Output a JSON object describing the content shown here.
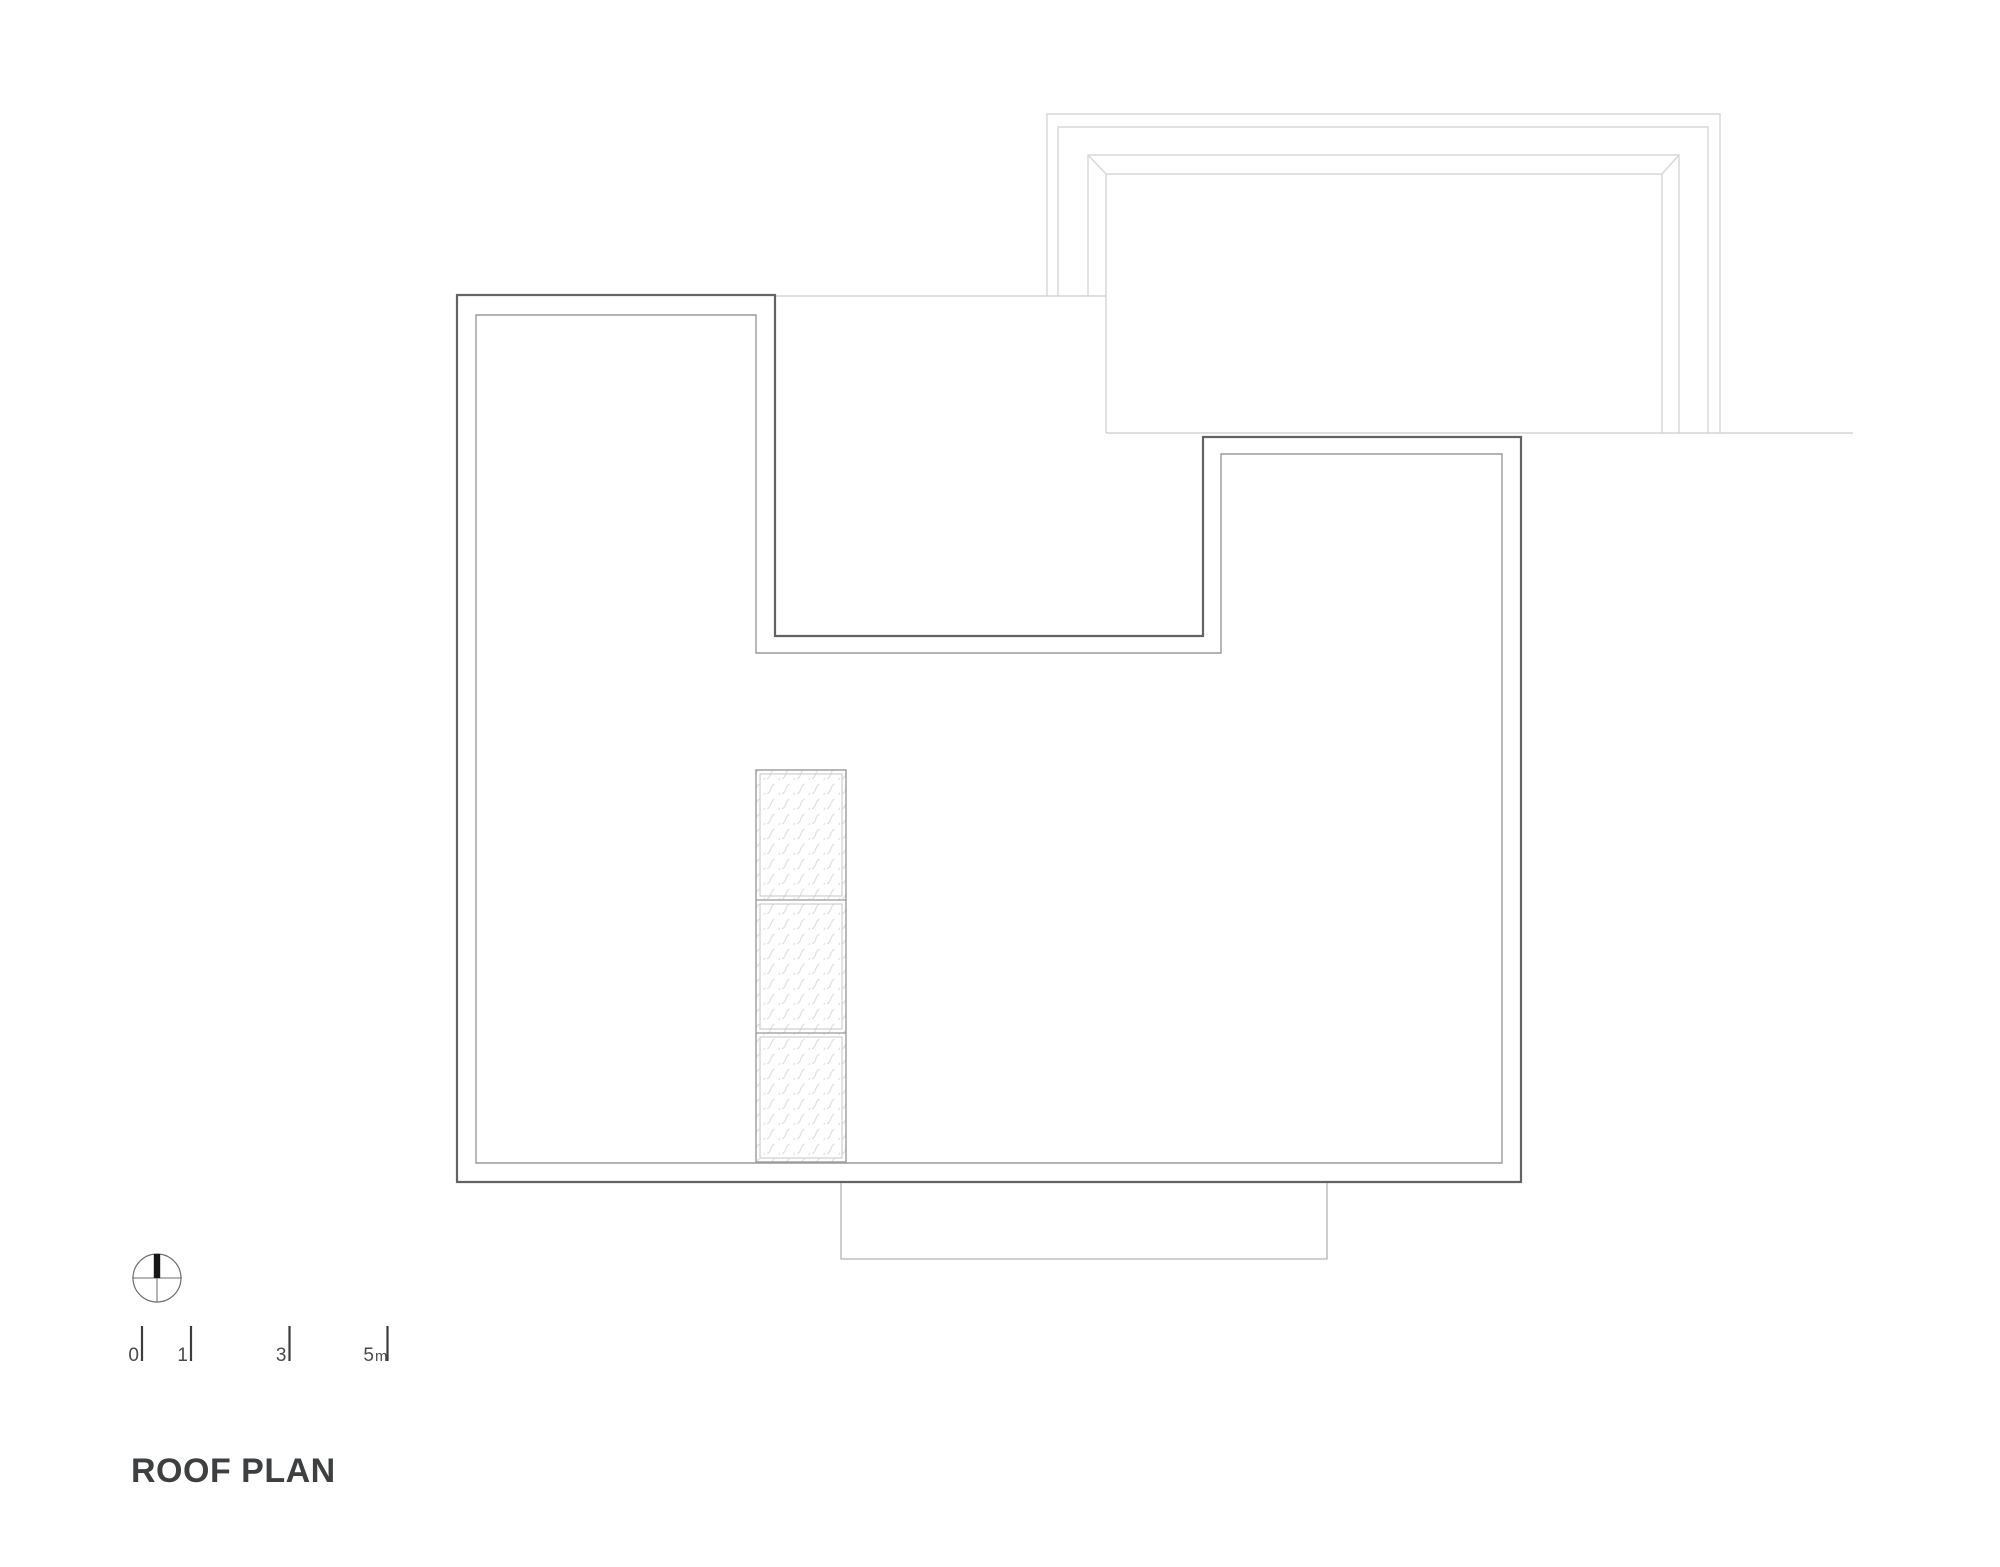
{
  "title": "ROOF PLAN",
  "scale_bar": {
    "labels": [
      "0",
      "1",
      "3",
      "5"
    ],
    "unit": "m"
  },
  "icons": {
    "north_arrow": "north-arrow-compass-icon"
  },
  "colors": {
    "background": "#ffffff",
    "main_outline": "#636366",
    "inner_offset_line": "#9b9b9b",
    "upper_roof_line": "#d7d7d7",
    "courtyard_line": "#cccccc",
    "terrace_line": "#b4b4b4",
    "skylight_border": "#9b9b9b",
    "skylight_inner_border": "#c6c6c6",
    "hatch_stroke": "#e0e0e0",
    "north_needle": "#161616",
    "scale_tick": "#3c3c3c",
    "text": "#3d3f41"
  }
}
